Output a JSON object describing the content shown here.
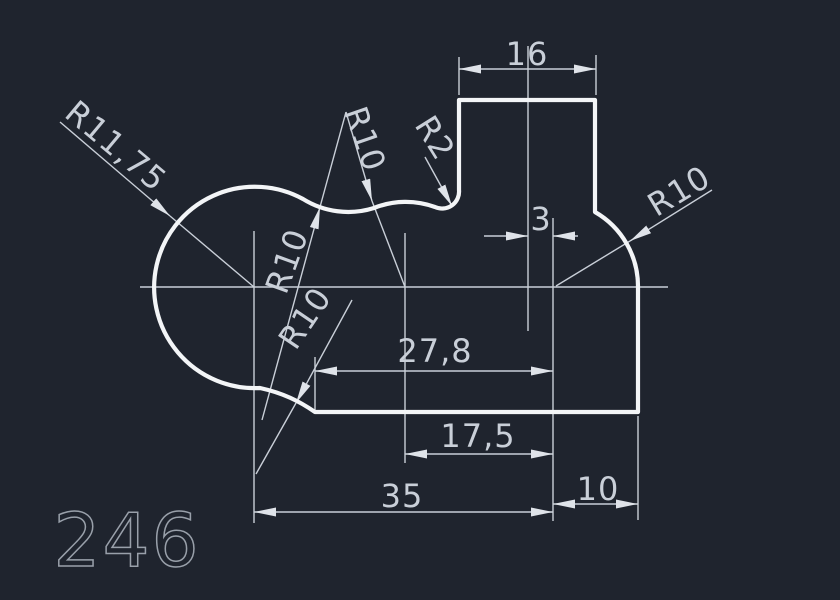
{
  "window": {
    "type": "cad-model-space",
    "background": "#1f242e"
  },
  "colors": {
    "outline": "#f3f5f7",
    "dimension": "#c9cfd8",
    "sheet_number": "#99a0aa",
    "background": "#1f242e"
  },
  "sheet_number": "246",
  "dimensions": {
    "linear": {
      "tab_width": "16",
      "tab_center_offset": "3",
      "bottom_tangent_to_center": "27,8",
      "hump_center_to_center": "17,5",
      "overall_centers": "35",
      "right_overhang": "10"
    },
    "radial": {
      "left_boss": "R11,75",
      "top_hump": "R10",
      "top_concave": "R10",
      "bottom_fillet": "R10",
      "tab_fillet": "R2",
      "body": "R10"
    }
  }
}
